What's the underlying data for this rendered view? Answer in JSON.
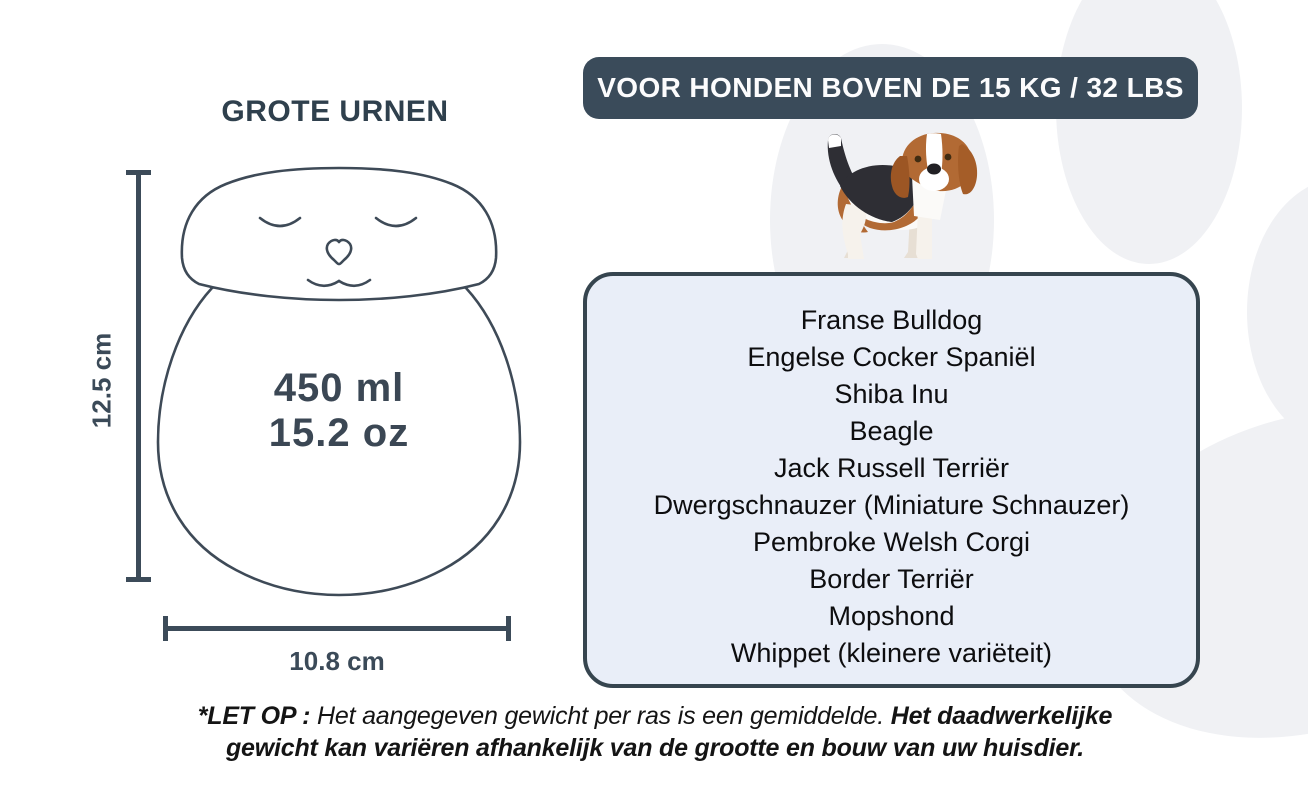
{
  "colors": {
    "dark_slate": "#3a4b5a",
    "box_fill": "#e9eef8",
    "box_border": "#36454f",
    "title_text": "#2f404d",
    "paw_gray": "#f0f1f4",
    "breed_text": "#0d0d0f",
    "dog_brown": "#b26a34",
    "dog_black": "#2e2e34"
  },
  "urn_section": {
    "title": "GROTE URNEN",
    "urn_icon": "cat-urn-line-drawing",
    "height_label": "12.5 cm",
    "width_label": "10.8 cm",
    "volume_line1": "450 ml",
    "volume_line2": "15.2 oz"
  },
  "dog_section": {
    "banner_label": "VOOR HONDEN BOVEN DE 15 KG / 32 LBS",
    "dog_icon": "beagle-illustration",
    "breeds": [
      "Franse Bulldog",
      "Engelse Cocker Spaniël",
      "Shiba Inu",
      "Beagle",
      "Jack Russell Terriër",
      "Dwergschnauzer (Miniature Schnauzer)",
      "Pembroke Welsh Corgi",
      "Border Terriër",
      "Mopshond",
      "Whippet (kleinere variëteit)"
    ]
  },
  "footnote": {
    "label_bold": "*LET OP :",
    "text_regular": "Het aangegeven gewicht per ras is een gemiddelde.",
    "text_bold": "Het daadwerkelijke gewicht kan variëren afhankelijk van de grootte en bouw van uw huisdier."
  }
}
